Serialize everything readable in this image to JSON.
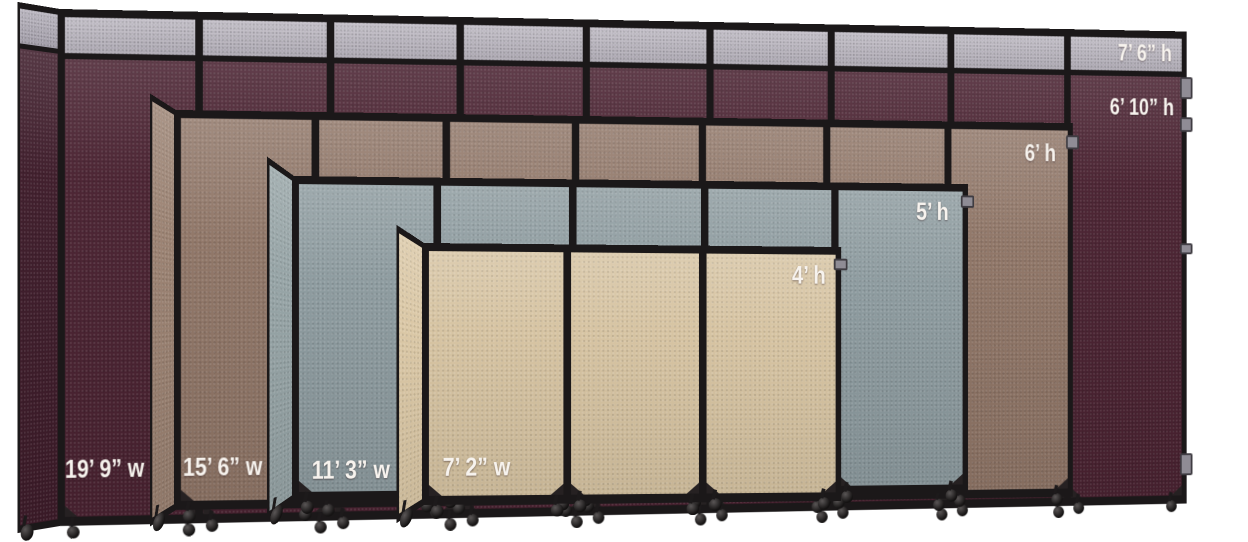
{
  "background_color": "#ffffff",
  "frame_color": "#1b1819",
  "label_color": "#f7f3ee",
  "hardware_tab_color": "#8f8c95",
  "partitions": [
    {
      "name": "cranberry",
      "fabric_color": "#4a2231",
      "end_color": "#3e1c2a",
      "extender_color": "#b3aeb9",
      "extender_end_color": "#a9a4b0",
      "panels": 9,
      "width_label": "19’ 9” w",
      "height_label_extended": "7’ 6” h",
      "height_label": "6’ 10” h"
    },
    {
      "name": "mocha",
      "fabric_color": "#8f7566",
      "end_color": "#9a8171",
      "panels": 7,
      "width_label": "15’ 6” w",
      "height_label": "6’ h"
    },
    {
      "name": "ocean",
      "fabric_color": "#8c9a9e",
      "end_color": "#95a3a5",
      "panels": 5,
      "width_label": "11’ 3” w",
      "height_label": "5’ h"
    },
    {
      "name": "sand",
      "fabric_color": "#d6c3a1",
      "end_color": "#dac7a5",
      "panels": 3,
      "width_label": "7’ 2” w",
      "height_label": "4’ h"
    }
  ]
}
